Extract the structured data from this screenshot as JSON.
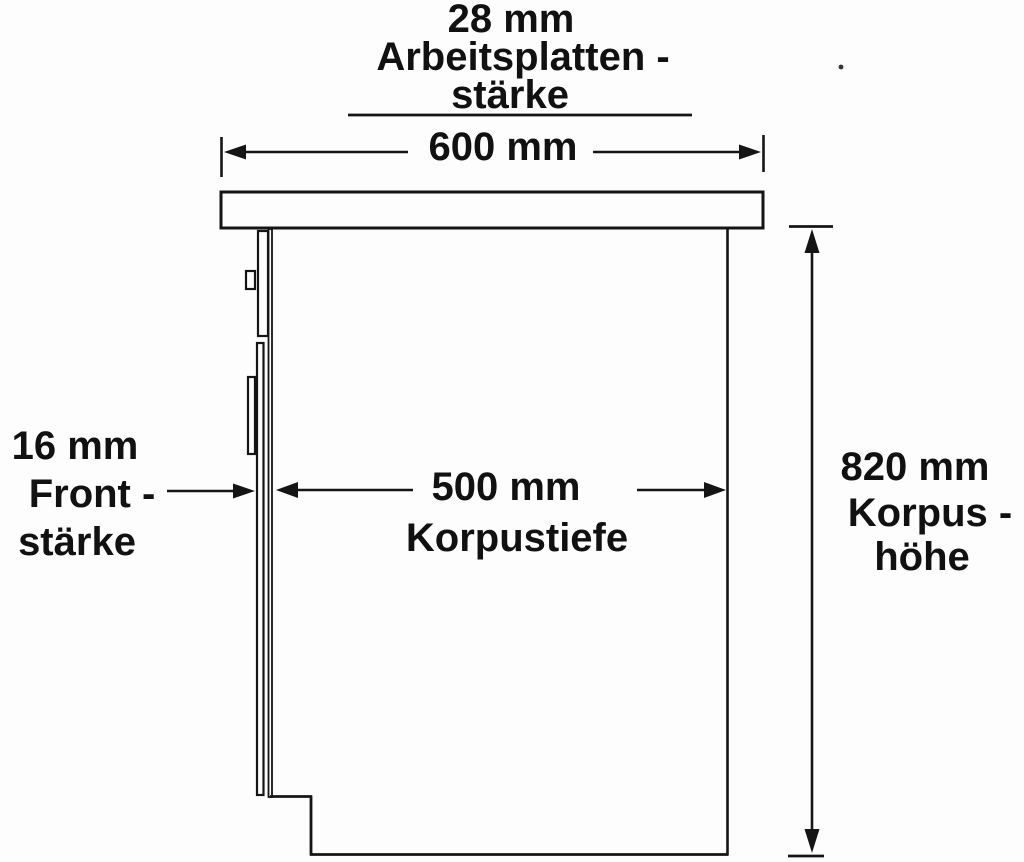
{
  "page": {
    "background_color": "#fdfdfd",
    "line_color": "#151515"
  },
  "diagram": {
    "kind": "cabinet-cross-section-side-view",
    "dimensions": {
      "worktop_thickness": {
        "value": "28 mm",
        "label": [
          "Arbeitsplatten -",
          "stärke"
        ]
      },
      "cabinet_width": {
        "value": "600 mm"
      },
      "front_thickness": {
        "value": "16 mm",
        "label": [
          "Front -",
          "stärke"
        ]
      },
      "body_depth": {
        "value": "500 mm",
        "label": [
          "Korpustiefe"
        ]
      },
      "body_height": {
        "value": "820 mm",
        "label": [
          "Korpus -",
          "höhe"
        ]
      }
    }
  }
}
